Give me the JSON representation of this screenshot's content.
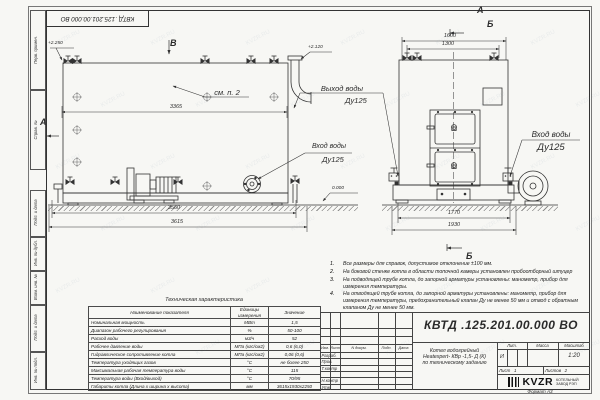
{
  "watermark": {
    "text": "KVZR.RU"
  },
  "frame": {
    "top_stamp": "КВТД .125.201.00.000  ВО",
    "format_label": "Формат  А3",
    "left_labels": [
      "Перв. примен.",
      "Справ. №",
      "Подп. и дата",
      "Инв. № дубл.",
      "Взам. инв. №",
      "Подп. и дата",
      "Инв. № подл."
    ]
  },
  "view_marks": {
    "v": "В",
    "a_side": "А",
    "a_top": "А",
    "b_top": "Б",
    "b_bottom": "Б"
  },
  "levels": {
    "top_left": "+2.250",
    "top_right": "+2.120",
    "zero": "0.000"
  },
  "dims": {
    "side_inner": "3365",
    "side_base": "3560",
    "side_overall": "3615",
    "front_top_outer": "1600",
    "front_top_inner": "1300",
    "front_bottom_inner": "1770",
    "front_bottom_outer": "1930"
  },
  "labels": {
    "see_note": "см. п. 2",
    "outlet": {
      "name": "Выход воды",
      "dn": "Ду125"
    },
    "inlet_side": {
      "name": "Вход воды",
      "dn": "Ду125"
    },
    "inlet_front": {
      "name": "Вход воды",
      "dn": "Ду125"
    }
  },
  "notes": [
    {
      "num": "1.",
      "text": "Все размеры для справок, допустимое отклонение ±100 мм."
    },
    {
      "num": "2.",
      "text": "На боковой стенке котла в области топочной камеры установлен пробоотборный штуцер"
    },
    {
      "num": "3.",
      "text": "На  подводящей трубе котла, до запорной арматуры установлены: манометр, прибор для измерения температуры."
    },
    {
      "num": "4.",
      "text": "На отводящей трубе котла, до запорной арматуры установлены: манометр, прибор для измерения температуры, предохранительный клапан Ду не менее 50 мм и отвод с обратным клапаном Ду не менее 50 мм."
    }
  ],
  "tech_table": {
    "title": "Техническая характеристика",
    "headers": [
      "Наименование показателя",
      "Единицы измерения",
      "Значение"
    ],
    "rows": [
      {
        "name": "Номинальная мощность",
        "unit": "МВт",
        "value": "1,5"
      },
      {
        "name": "Диапазон рабочего регулирования",
        "unit": "%",
        "value": "50-100"
      },
      {
        "name": "Расход воды",
        "unit": "м3/ч",
        "value": "52"
      },
      {
        "name": "Рабочее давление воды",
        "unit": "МПа (кгс/см2)",
        "value": "0,6 (6,0)"
      },
      {
        "name": "Гидравлическое сопротивление котла",
        "unit": "МПа (кгс/см2)",
        "value": "0,06 (0,6)"
      },
      {
        "name": "Температура уходящих газов",
        "unit": "°С",
        "value": "не более 250"
      },
      {
        "name": "Максимальная рабочая температура воды",
        "unit": "°С",
        "value": "115"
      },
      {
        "name": "Температура воды (Вход/выход)",
        "unit": "°С",
        "value": "70/95"
      },
      {
        "name": "Габариты котла (Длина х ширина х высота)",
        "unit": "мм",
        "value": "3615х1930х2250"
      }
    ]
  },
  "title_block": {
    "doc_number": "КВТД .125.201.00.000  ВО",
    "product_name_lines": [
      "Котел водогрейный",
      "Heatexpert- КВр -1,5- Д (К)",
      "по техническому заданию"
    ],
    "header_cols": [
      "Изм.",
      "Лист",
      "N докум.",
      "Подп.",
      "Дата"
    ],
    "row_labels": [
      "Разраб.",
      "Пров.",
      "Т.контр",
      "Н.контр",
      "Утв."
    ],
    "lit_header": "Лит.",
    "mass_header": "Масса",
    "scale_header": "Масштаб",
    "lit_value": "И",
    "scale_value": "1:20",
    "sheet_label": "Лист",
    "sheet_value": "1",
    "sheets_label": "Листов",
    "sheets_value": "2",
    "logo_text": "KVZR",
    "logo_caption_lines": [
      "КОТЕЛЬНЫЙ",
      "ЗАВОД РЭП"
    ]
  }
}
